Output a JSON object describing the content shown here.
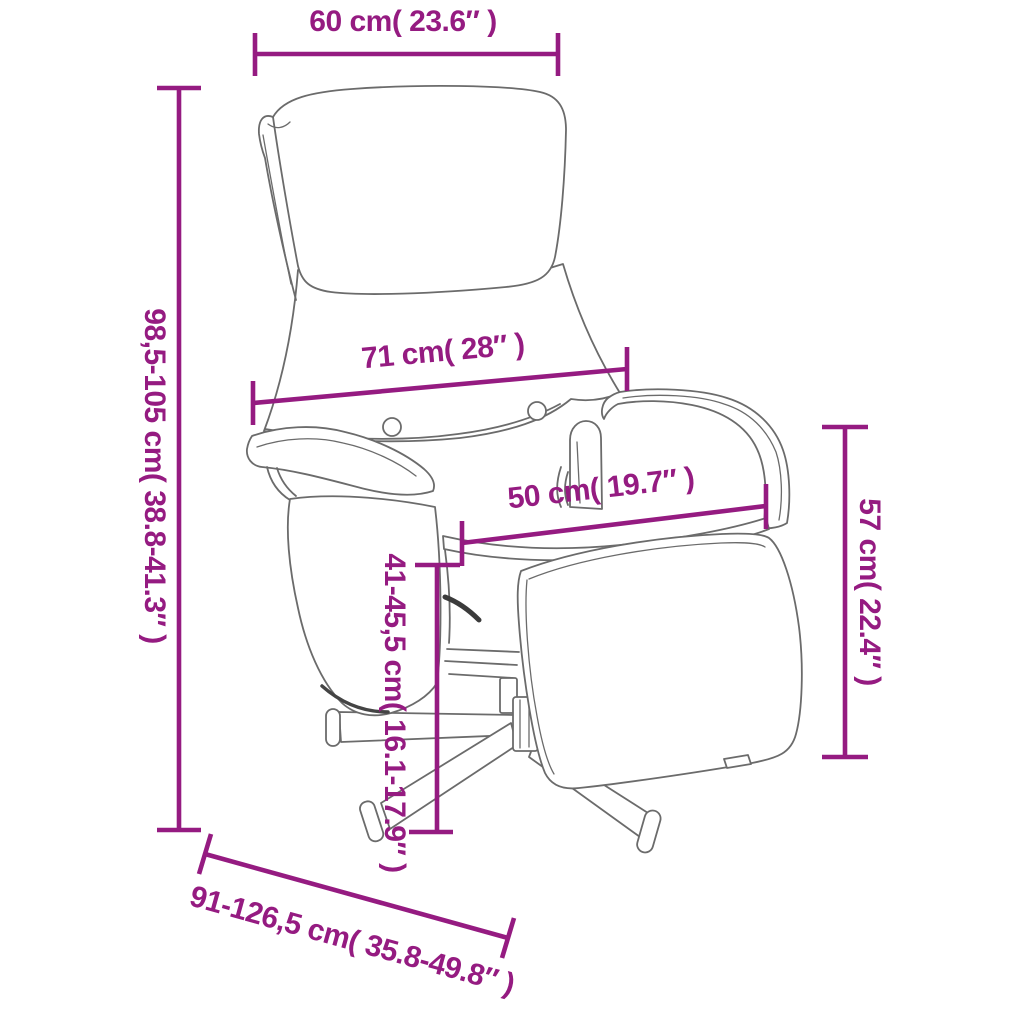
{
  "diagram": {
    "title": "Recliner chair with footrest - dimensions diagram",
    "subject": "recliner-chair-line-drawing",
    "accent_color": "#951b81",
    "drawing_color": "#6b6b6b",
    "background": "#ffffff",
    "measurements": {
      "headrest_width": {
        "label": "60 cm( 23.6″ )"
      },
      "total_height": {
        "label": "98,5-105 cm( 38.8-41.3″ )"
      },
      "backrest_width": {
        "label": "71 cm( 28″ )"
      },
      "seat_width": {
        "label": "50 cm( 19.7″ )"
      },
      "armrest_height": {
        "label": "57 cm( 22.4″ )"
      },
      "seat_height": {
        "label": "41-45,5 cm( 16.1-17.9″ )"
      },
      "total_depth": {
        "label": "91-126,5 cm( 35.8-49.8″ )"
      }
    }
  }
}
